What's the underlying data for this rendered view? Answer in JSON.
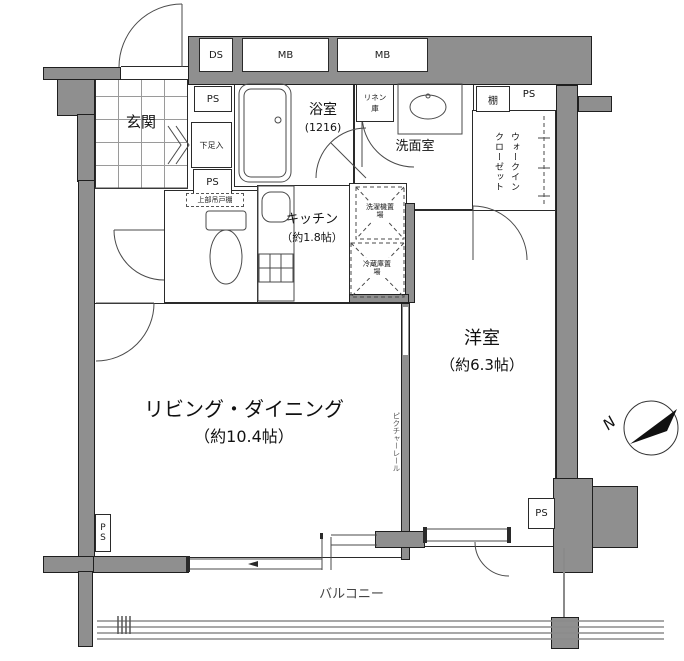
{
  "floorplan": {
    "ducts": {
      "ds": "DS",
      "mb_left": "MB",
      "mb_right": "MB"
    },
    "ps": {
      "top": "PS",
      "mid": "PS",
      "wic": "PS",
      "bottom_left": "PS",
      "bottom_right": "PS"
    },
    "rooms": {
      "genkan": "玄関",
      "bathroom": "浴室",
      "bathroom_size": "(1216)",
      "washroom": "洗面室",
      "kitchen": "キッチン",
      "kitchen_size": "（約1.8帖）",
      "living": "リビング・ダイニング",
      "living_size": "（約10.4帖）",
      "western": "洋室",
      "western_size": "（約6.3帖）",
      "wic": "ウォークインクローゼット",
      "balcony": "バルコニー"
    },
    "fixtures": {
      "shoe_cabinet": "下足入",
      "linen_closet": "リネン庫",
      "shelf": "棚",
      "upper_cabinet": "上部吊戸棚",
      "washer_space": "洗濯機置場",
      "fridge_space": "冷蔵庫置場",
      "picture_rail": "ピクチャーレール"
    },
    "compass": {
      "north": "N"
    },
    "colors": {
      "wall": "#8f8f8f",
      "line": "#333333"
    }
  }
}
